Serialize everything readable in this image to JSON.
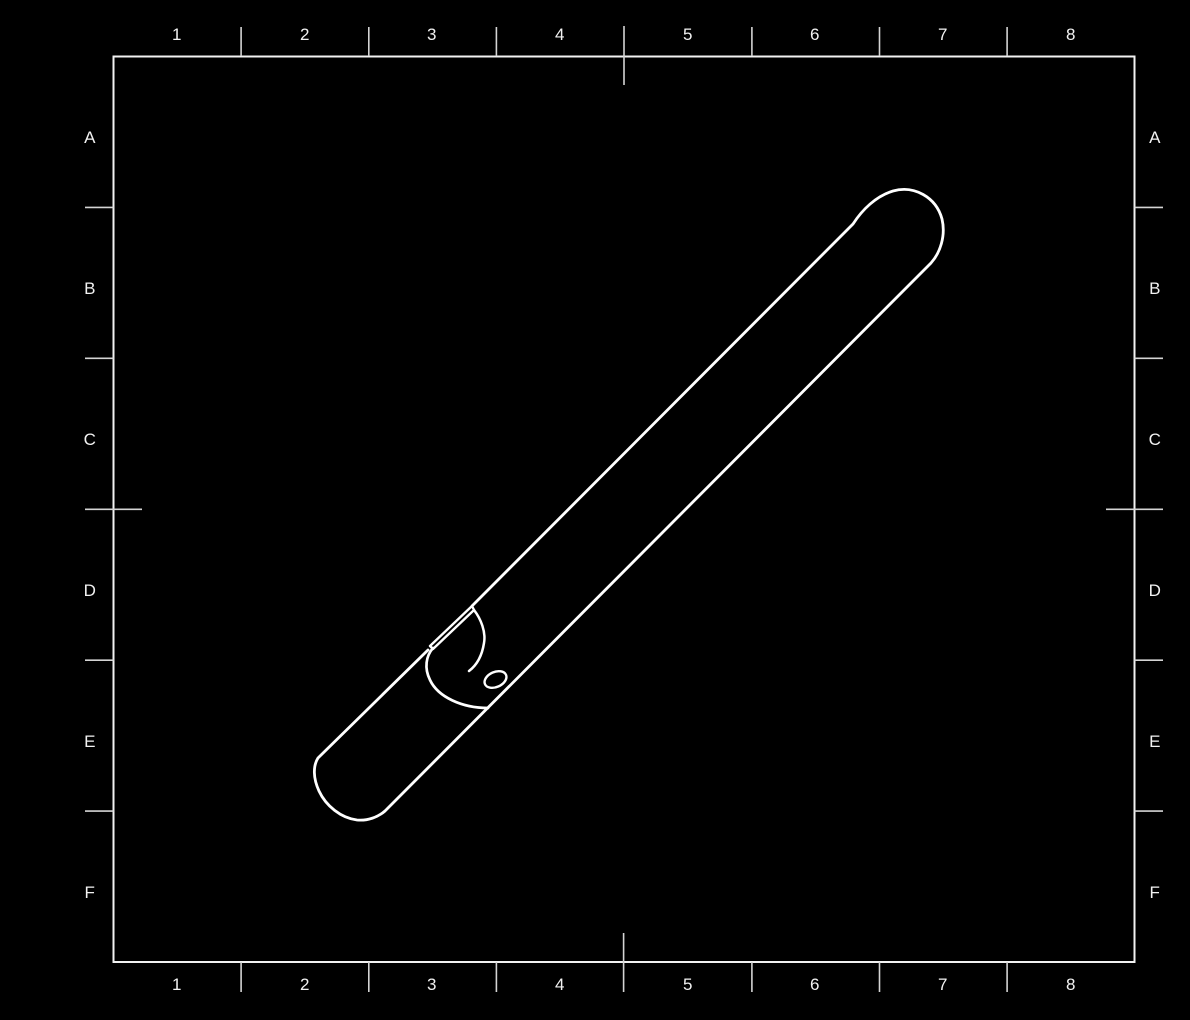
{
  "sheet": {
    "background_color": "#000000",
    "frame_color": "#f2f2f2",
    "tick_color": "#d4d4d4",
    "part_color": "#ffffff",
    "columns": [
      "1",
      "2",
      "3",
      "4",
      "5",
      "6",
      "7",
      "8"
    ],
    "rows": [
      "A",
      "B",
      "C",
      "D",
      "E",
      "F"
    ],
    "part_name": "round bar with milled notch and cross hole, isometric view"
  }
}
